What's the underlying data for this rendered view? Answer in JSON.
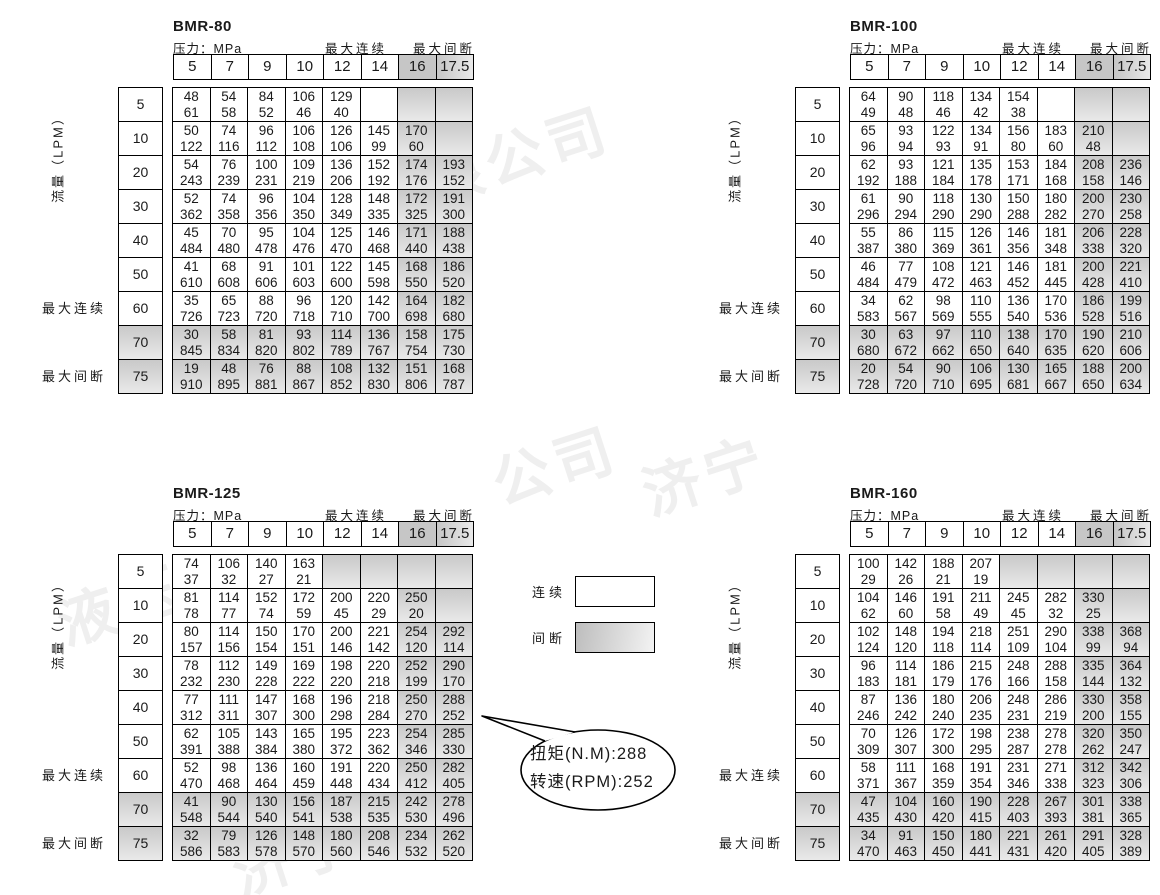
{
  "labels": {
    "pressure": "压力：MPa",
    "max_continuous": "最大连续",
    "max_intermittent": "最大间断",
    "flow": "流量（LPM）"
  },
  "legend": {
    "continuous_label": "连续",
    "intermittent_label": "间断"
  },
  "callout": {
    "line1": "扭矩(N.M):288",
    "line2": "转速(RPM):252"
  },
  "watermarks": [
    "限公司",
    "公司",
    "济宁",
    "液压",
    "济宁",
    "有限"
  ],
  "chart_data": [
    {
      "type": "table",
      "title": "BMR-80",
      "xlabel": "压力：MPa",
      "ylabel": "流量（LPM）",
      "cell_format": "top=扭矩 torque N.M, bottom=转速 speed RPM",
      "pressure_mpa": [
        "5",
        "7",
        "9",
        "10",
        "12",
        "14",
        "16",
        "17.5"
      ],
      "flow_lpm": [
        "5",
        "10",
        "20",
        "30",
        "40",
        "50",
        "60",
        "70",
        "75"
      ],
      "row5_blank_shaded": false,
      "cells": [
        [
          [
            48,
            61
          ],
          [
            54,
            58
          ],
          [
            84,
            52
          ],
          [
            106,
            46
          ],
          [
            129,
            40
          ],
          [],
          [],
          []
        ],
        [
          [
            50,
            122
          ],
          [
            74,
            116
          ],
          [
            96,
            112
          ],
          [
            106,
            108
          ],
          [
            126,
            106
          ],
          [
            145,
            99
          ],
          [
            170,
            60
          ],
          []
        ],
        [
          [
            54,
            243
          ],
          [
            76,
            239
          ],
          [
            100,
            231
          ],
          [
            109,
            219
          ],
          [
            136,
            206
          ],
          [
            152,
            192
          ],
          [
            174,
            176
          ],
          [
            193,
            152
          ]
        ],
        [
          [
            52,
            362
          ],
          [
            74,
            358
          ],
          [
            96,
            356
          ],
          [
            104,
            350
          ],
          [
            128,
            349
          ],
          [
            148,
            335
          ],
          [
            172,
            325
          ],
          [
            191,
            300
          ]
        ],
        [
          [
            45,
            484
          ],
          [
            70,
            480
          ],
          [
            95,
            478
          ],
          [
            104,
            476
          ],
          [
            125,
            470
          ],
          [
            146,
            468
          ],
          [
            171,
            440
          ],
          [
            188,
            438
          ]
        ],
        [
          [
            41,
            610
          ],
          [
            68,
            608
          ],
          [
            91,
            606
          ],
          [
            101,
            603
          ],
          [
            122,
            600
          ],
          [
            145,
            598
          ],
          [
            168,
            550
          ],
          [
            186,
            520
          ]
        ],
        [
          [
            35,
            726
          ],
          [
            65,
            723
          ],
          [
            88,
            720
          ],
          [
            96,
            718
          ],
          [
            120,
            710
          ],
          [
            142,
            700
          ],
          [
            164,
            698
          ],
          [
            182,
            680
          ]
        ],
        [
          [
            30,
            845
          ],
          [
            58,
            834
          ],
          [
            81,
            820
          ],
          [
            93,
            802
          ],
          [
            114,
            789
          ],
          [
            136,
            767
          ],
          [
            158,
            754
          ],
          [
            175,
            730
          ]
        ],
        [
          [
            19,
            910
          ],
          [
            48,
            895
          ],
          [
            76,
            881
          ],
          [
            88,
            867
          ],
          [
            108,
            852
          ],
          [
            132,
            830
          ],
          [
            151,
            806
          ],
          [
            168,
            787
          ]
        ]
      ]
    },
    {
      "type": "table",
      "title": "BMR-100",
      "xlabel": "压力：MPa",
      "ylabel": "流量（LPM）",
      "cell_format": "top=扭矩 torque N.M, bottom=转速 speed RPM",
      "pressure_mpa": [
        "5",
        "7",
        "9",
        "10",
        "12",
        "14",
        "16",
        "17.5"
      ],
      "flow_lpm": [
        "5",
        "10",
        "20",
        "30",
        "40",
        "50",
        "60",
        "70",
        "75"
      ],
      "row5_blank_shaded": false,
      "cells": [
        [
          [
            64,
            49
          ],
          [
            90,
            48
          ],
          [
            118,
            46
          ],
          [
            134,
            42
          ],
          [
            154,
            38
          ],
          [],
          [],
          []
        ],
        [
          [
            65,
            96
          ],
          [
            93,
            94
          ],
          [
            122,
            93
          ],
          [
            134,
            91
          ],
          [
            156,
            80
          ],
          [
            183,
            60
          ],
          [
            210,
            48
          ],
          []
        ],
        [
          [
            62,
            192
          ],
          [
            93,
            188
          ],
          [
            121,
            184
          ],
          [
            135,
            178
          ],
          [
            153,
            171
          ],
          [
            184,
            168
          ],
          [
            208,
            158
          ],
          [
            236,
            146
          ]
        ],
        [
          [
            61,
            296
          ],
          [
            90,
            294
          ],
          [
            118,
            290
          ],
          [
            130,
            290
          ],
          [
            150,
            288
          ],
          [
            180,
            282
          ],
          [
            200,
            270
          ],
          [
            230,
            258
          ]
        ],
        [
          [
            55,
            387
          ],
          [
            86,
            380
          ],
          [
            115,
            369
          ],
          [
            126,
            361
          ],
          [
            146,
            356
          ],
          [
            181,
            348
          ],
          [
            206,
            338
          ],
          [
            228,
            320
          ]
        ],
        [
          [
            46,
            484
          ],
          [
            77,
            479
          ],
          [
            108,
            472
          ],
          [
            121,
            463
          ],
          [
            146,
            452
          ],
          [
            181,
            445
          ],
          [
            200,
            428
          ],
          [
            221,
            410
          ]
        ],
        [
          [
            34,
            583
          ],
          [
            62,
            567
          ],
          [
            98,
            569
          ],
          [
            110,
            555
          ],
          [
            136,
            540
          ],
          [
            170,
            536
          ],
          [
            186,
            528
          ],
          [
            199,
            516
          ]
        ],
        [
          [
            30,
            680
          ],
          [
            63,
            672
          ],
          [
            97,
            662
          ],
          [
            110,
            650
          ],
          [
            138,
            640
          ],
          [
            170,
            635
          ],
          [
            190,
            620
          ],
          [
            210,
            606
          ]
        ],
        [
          [
            20,
            728
          ],
          [
            54,
            720
          ],
          [
            90,
            710
          ],
          [
            106,
            695
          ],
          [
            130,
            681
          ],
          [
            165,
            667
          ],
          [
            188,
            650
          ],
          [
            200,
            634
          ]
        ]
      ]
    },
    {
      "type": "table",
      "title": "BMR-125",
      "xlabel": "压力：MPa",
      "ylabel": "流量（LPM）",
      "cell_format": "top=扭矩 torque N.M, bottom=转速 speed RPM",
      "pressure_mpa": [
        "5",
        "7",
        "9",
        "10",
        "12",
        "14",
        "16",
        "17.5"
      ],
      "flow_lpm": [
        "5",
        "10",
        "20",
        "30",
        "40",
        "50",
        "60",
        "70",
        "75"
      ],
      "row5_blank_shaded": true,
      "cells": [
        [
          [
            74,
            37
          ],
          [
            106,
            32
          ],
          [
            140,
            27
          ],
          [
            163,
            21
          ],
          [],
          [],
          [],
          []
        ],
        [
          [
            81,
            78
          ],
          [
            114,
            77
          ],
          [
            152,
            74
          ],
          [
            172,
            59
          ],
          [
            200,
            45
          ],
          [
            220,
            29
          ],
          [
            250,
            20
          ],
          []
        ],
        [
          [
            80,
            157
          ],
          [
            114,
            156
          ],
          [
            150,
            154
          ],
          [
            170,
            151
          ],
          [
            200,
            146
          ],
          [
            221,
            142
          ],
          [
            254,
            120
          ],
          [
            292,
            114
          ]
        ],
        [
          [
            78,
            232
          ],
          [
            112,
            230
          ],
          [
            149,
            228
          ],
          [
            169,
            222
          ],
          [
            198,
            220
          ],
          [
            220,
            218
          ],
          [
            252,
            199
          ],
          [
            290,
            170
          ]
        ],
        [
          [
            77,
            312
          ],
          [
            111,
            311
          ],
          [
            147,
            307
          ],
          [
            168,
            300
          ],
          [
            196,
            298
          ],
          [
            218,
            284
          ],
          [
            250,
            270
          ],
          [
            288,
            252
          ]
        ],
        [
          [
            62,
            391
          ],
          [
            105,
            388
          ],
          [
            143,
            384
          ],
          [
            165,
            380
          ],
          [
            195,
            372
          ],
          [
            223,
            362
          ],
          [
            254,
            346
          ],
          [
            285,
            330
          ]
        ],
        [
          [
            52,
            470
          ],
          [
            98,
            468
          ],
          [
            136,
            464
          ],
          [
            160,
            459
          ],
          [
            191,
            448
          ],
          [
            220,
            434
          ],
          [
            250,
            412
          ],
          [
            282,
            405
          ]
        ],
        [
          [
            41,
            548
          ],
          [
            90,
            544
          ],
          [
            130,
            540
          ],
          [
            156,
            541
          ],
          [
            187,
            538
          ],
          [
            215,
            535
          ],
          [
            242,
            530
          ],
          [
            278,
            496
          ]
        ],
        [
          [
            32,
            586
          ],
          [
            79,
            583
          ],
          [
            126,
            578
          ],
          [
            148,
            570
          ],
          [
            180,
            560
          ],
          [
            208,
            546
          ],
          [
            234,
            532
          ],
          [
            262,
            520
          ]
        ]
      ]
    },
    {
      "type": "table",
      "title": "BMR-160",
      "xlabel": "压力：MPa",
      "ylabel": "流量（LPM）",
      "cell_format": "top=扭矩 torque N.M, bottom=转速 speed RPM",
      "pressure_mpa": [
        "5",
        "7",
        "9",
        "10",
        "12",
        "14",
        "16",
        "17.5"
      ],
      "flow_lpm": [
        "5",
        "10",
        "20",
        "30",
        "40",
        "50",
        "60",
        "70",
        "75"
      ],
      "row5_blank_shaded": true,
      "cells": [
        [
          [
            100,
            29
          ],
          [
            142,
            26
          ],
          [
            188,
            21
          ],
          [
            207,
            19
          ],
          [],
          [],
          [],
          []
        ],
        [
          [
            104,
            62
          ],
          [
            146,
            60
          ],
          [
            191,
            58
          ],
          [
            211,
            49
          ],
          [
            245,
            45
          ],
          [
            282,
            32
          ],
          [
            330,
            25
          ],
          []
        ],
        [
          [
            102,
            124
          ],
          [
            148,
            120
          ],
          [
            194,
            118
          ],
          [
            218,
            114
          ],
          [
            251,
            109
          ],
          [
            290,
            104
          ],
          [
            338,
            99
          ],
          [
            368,
            94
          ]
        ],
        [
          [
            96,
            183
          ],
          [
            114,
            181
          ],
          [
            186,
            179
          ],
          [
            215,
            176
          ],
          [
            248,
            166
          ],
          [
            288,
            158
          ],
          [
            335,
            144
          ],
          [
            364,
            132
          ]
        ],
        [
          [
            87,
            246
          ],
          [
            136,
            242
          ],
          [
            180,
            240
          ],
          [
            206,
            235
          ],
          [
            248,
            231
          ],
          [
            286,
            219
          ],
          [
            330,
            200
          ],
          [
            358,
            155
          ]
        ],
        [
          [
            70,
            309
          ],
          [
            126,
            307
          ],
          [
            172,
            300
          ],
          [
            198,
            295
          ],
          [
            238,
            287
          ],
          [
            278,
            278
          ],
          [
            320,
            262
          ],
          [
            350,
            247
          ]
        ],
        [
          [
            58,
            371
          ],
          [
            111,
            367
          ],
          [
            168,
            359
          ],
          [
            191,
            354
          ],
          [
            231,
            346
          ],
          [
            271,
            338
          ],
          [
            312,
            323
          ],
          [
            342,
            306
          ]
        ],
        [
          [
            47,
            435
          ],
          [
            104,
            430
          ],
          [
            160,
            420
          ],
          [
            190,
            415
          ],
          [
            228,
            403
          ],
          [
            267,
            393
          ],
          [
            301,
            381
          ],
          [
            338,
            365
          ]
        ],
        [
          [
            34,
            470
          ],
          [
            91,
            463
          ],
          [
            150,
            450
          ],
          [
            180,
            441
          ],
          [
            221,
            431
          ],
          [
            261,
            420
          ],
          [
            291,
            405
          ],
          [
            328,
            389
          ]
        ]
      ]
    }
  ]
}
